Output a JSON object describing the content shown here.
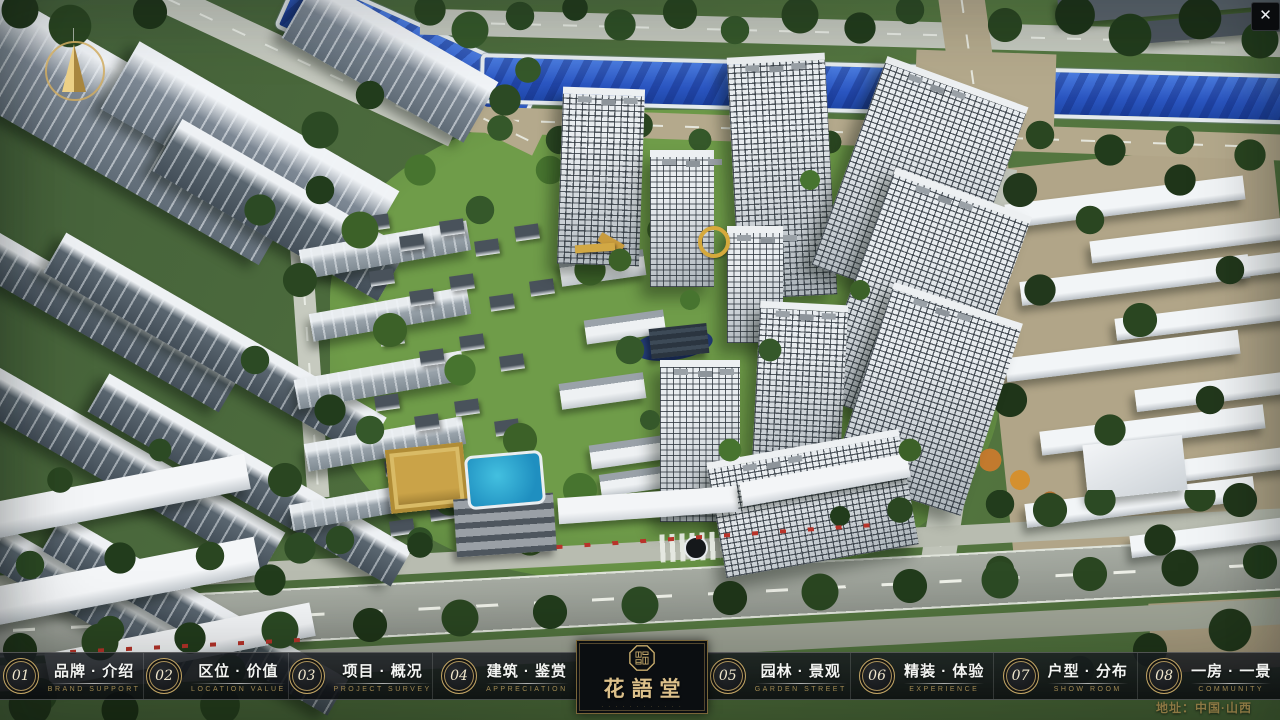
{
  "window": {
    "close_icon": "✕"
  },
  "icons": {
    "compass": "north-arrow",
    "seal": "chinese-seal-emblem"
  },
  "menu": {
    "items": [
      {
        "num": "01",
        "cn": "品牌 · 介绍",
        "en": "BRAND SUPPORT"
      },
      {
        "num": "02",
        "cn": "区位 · 价值",
        "en": "LOCATION VALUE"
      },
      {
        "num": "03",
        "cn": "项目 · 概况",
        "en": "PROJECT SURVEY"
      },
      {
        "num": "04",
        "cn": "建筑 · 鉴赏",
        "en": "APPRECIATION"
      },
      {
        "num": "05",
        "cn": "园林 · 景观",
        "en": "GARDEN STREET"
      },
      {
        "num": "06",
        "cn": "精装 · 体验",
        "en": "EXPERIENCE"
      },
      {
        "num": "07",
        "cn": "户型 · 分布",
        "en": "SHOW ROOM"
      },
      {
        "num": "08",
        "cn": "一房 · 一景",
        "en": "COMMUNITY"
      }
    ]
  },
  "logo": {
    "title": "花語堂",
    "tagline": "· · · · · · · · · · · ·"
  },
  "footer": {
    "address": "地址：中国·山西"
  },
  "colors": {
    "gold": "#c2a564",
    "river_blue": "#2a55c0",
    "menu_bg": "#101318"
  }
}
